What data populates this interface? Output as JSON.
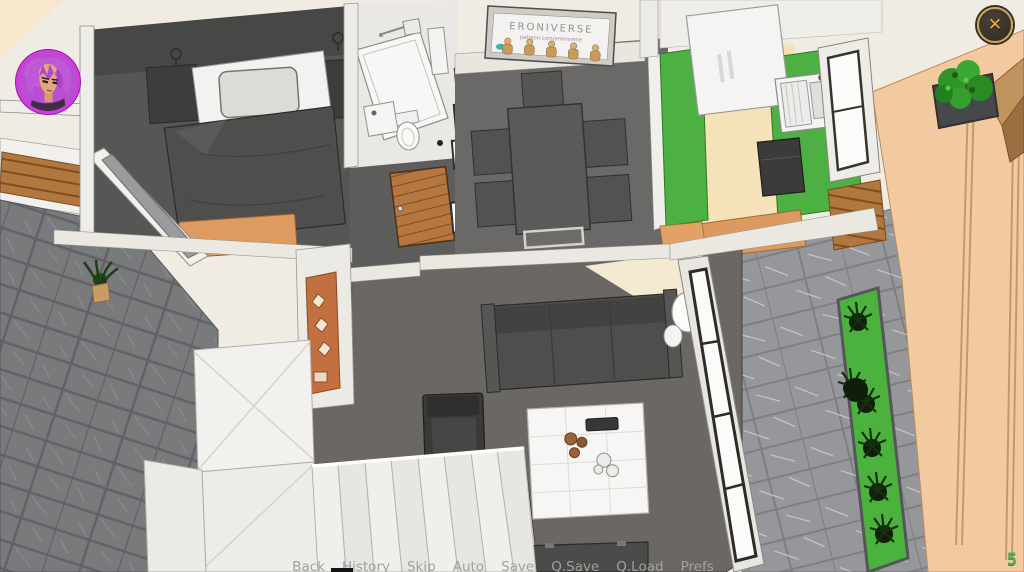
{
  "scene": {
    "poster": {
      "title": "ERONIVERSE",
      "subtitle": "patreon.com/eroniverse"
    }
  },
  "hud": {
    "counter_value": "5",
    "close_icon": "✕"
  },
  "quick_menu": {
    "items": [
      "Back",
      "History",
      "Skip",
      "Auto",
      "Save",
      "Q.Save",
      "Q.Load",
      "Prefs"
    ]
  },
  "colors": {
    "accent_green": "#4db043",
    "counter_green": "#5cb04a",
    "gold": "#caa452",
    "avatar_ring": "#d23ae0",
    "floor_dark": "#6a6765",
    "terrace_slate": "#797a7c",
    "terrace_stone": "#96979a",
    "wood": "#b0773f",
    "tan_wall": "#f3caa0"
  }
}
